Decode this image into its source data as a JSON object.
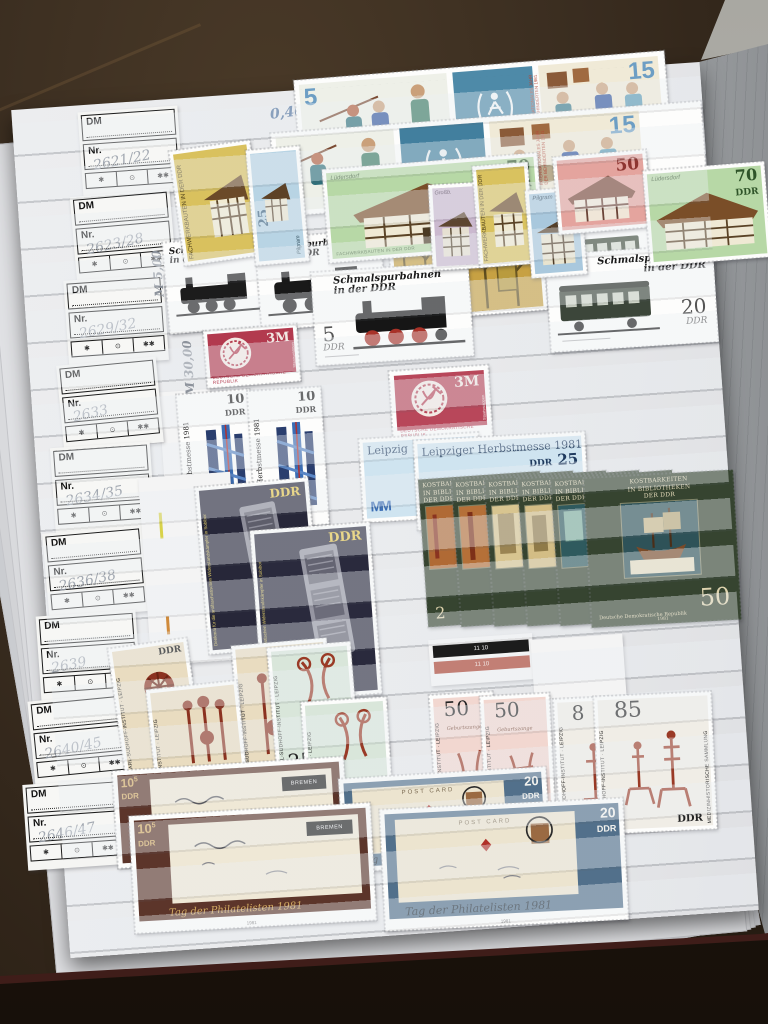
{
  "album": {
    "labels": {
      "dm": "DM",
      "nr": "Nr.",
      "symbols": {
        "mint": "✱",
        "used": "⊙",
        "mnh": "✱✱"
      },
      "entries": [
        "2621/22",
        "2623/28",
        "2629/32",
        "2633",
        "2634/35",
        "2636/38",
        "2639",
        "2640/45",
        "2646/47"
      ]
    },
    "annotations": {
      "a040": "0,40",
      "m500": "M 5,00",
      "m2500": "M 25,00",
      "a160": "1,60",
      "a450": "4,50",
      "m3000": "M 30,00",
      "m4250": "M 42,50"
    }
  },
  "stamps": {
    "behinderte": {
      "v5": "5",
      "v15": "15",
      "side": "INTERNATIONALES JAHR DER BEHINDERTEN 1981"
    },
    "fachwerk": {
      "series": "FACHWERKBAUTEN IN DER DDR",
      "ddr": "DDR",
      "v25": "25",
      "v50": "50",
      "v70": "70",
      "name70": "Lüdersdorf",
      "namePilgram": "Pilgram",
      "nameGross": "Großb."
    },
    "schmalspur": {
      "title": "Schmalspurbahnen",
      "title2": "in der DDR",
      "v5": "5",
      "v20": "20",
      "ddr": "DDR"
    },
    "wappen": {
      "value": "3M",
      "country": "DEUTSCHE DEMOKRATISCHE REPUBLIK",
      "side": "Staatswappen"
    },
    "messe10": {
      "title": "Leipziger Herbstmesse 1981",
      "v": "10",
      "ddr": "DDR",
      "logo": "MM"
    },
    "messe25": {
      "title": "Leipziger Herbstmesse 1981",
      "titleClip": "Leipzig",
      "ddr": "DDR",
      "v": "25",
      "logo": "MM"
    },
    "sobibor": {
      "ddr": "DDR",
      "side": "Denkmal für die antifaschistischen Widerstandskämpfer in Sobibor"
    },
    "kost": {
      "l1": "KOSTBARKEITEN",
      "l2": "IN BIBLIOTHEKEN",
      "l3": "DER DDR",
      "v50": "50",
      "v2": "2",
      "country": "Deutsche Demokratische Republik",
      "year": "1981"
    },
    "sudhoff": {
      "inst": "KARL-SUDHOFF-INSTITUT · LEIPZIG",
      "v20": "20",
      "v25": "25",
      "v50": "50",
      "v8": "8",
      "v85": "85",
      "ddr": "DDR",
      "sammlung": "MEDIZINHISTORISCHE SAMMLUNG",
      "caption": "Geburtszange",
      "ctrl": "11  10"
    },
    "phil": {
      "v10": "10",
      "sup": "5",
      "v20": "20",
      "ddr": "DDR",
      "bremen": "BREMEN",
      "postcard": "POST CARD",
      "script": "Tag der Philatelisten 1981",
      "scriptClip": "Tag der",
      "year": "1981"
    }
  }
}
